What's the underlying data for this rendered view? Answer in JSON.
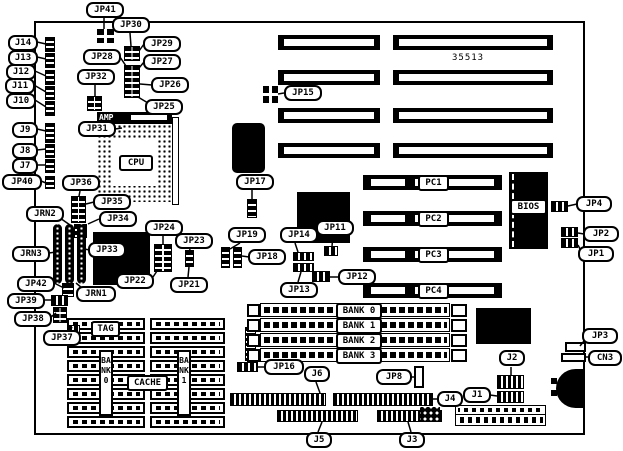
{
  "diagram": {
    "part_number": "35513",
    "labels": {
      "j14": "J14",
      "j13": "J13",
      "j12": "J12",
      "j11": "J11",
      "j10": "J10",
      "j9": "J9",
      "j8": "J8",
      "j7": "J7",
      "jp40": "JP40",
      "jp41": "JP41",
      "jp30": "JP30",
      "jp29": "JP29",
      "jp28": "JP28",
      "jp27": "JP27",
      "jp32": "JP32",
      "jp26": "JP26",
      "jp25": "JP25",
      "amp": "AMP",
      "jp31": "JP31",
      "cpu": "CPU",
      "jp36": "JP36",
      "jp35": "JP35",
      "jrn2": "JRN2",
      "jp34": "JP34",
      "jrn3": "JRN3",
      "jp33": "JP33",
      "jp24": "JP24",
      "jp23": "JP23",
      "jp22": "JP22",
      "jp21": "JP21",
      "jrn1": "JRN1",
      "jp42": "JP42",
      "jp39": "JP39",
      "jp38": "JP38",
      "jp37": "JP37",
      "tag": "TAG",
      "cache": "CACHE",
      "bank0v": "BANK0",
      "bank1v": "BANK1",
      "jp15": "JP15",
      "jp17": "JP17",
      "jp19": "JP19",
      "jp18": "JP18",
      "jp14": "JP14",
      "jp11": "JP11",
      "jp13": "JP13",
      "jp12": "JP12",
      "pc1": "PC1",
      "pc2": "PC2",
      "pc3": "PC3",
      "pc4": "PC4",
      "bios": "BIOS",
      "jp4": "JP4",
      "jp2": "JP2",
      "jp1": "JP1",
      "bank0": "BANK 0",
      "bank1": "BANK 1",
      "bank2": "BANK 2",
      "bank3": "BANK 3",
      "jp16": "JP16",
      "j6": "J6",
      "jp8": "JP8",
      "j4": "J4",
      "j1": "J1",
      "j2": "J2",
      "j5": "J5",
      "j3": "J3",
      "jp3": "JP3",
      "cn3": "CN3"
    }
  }
}
